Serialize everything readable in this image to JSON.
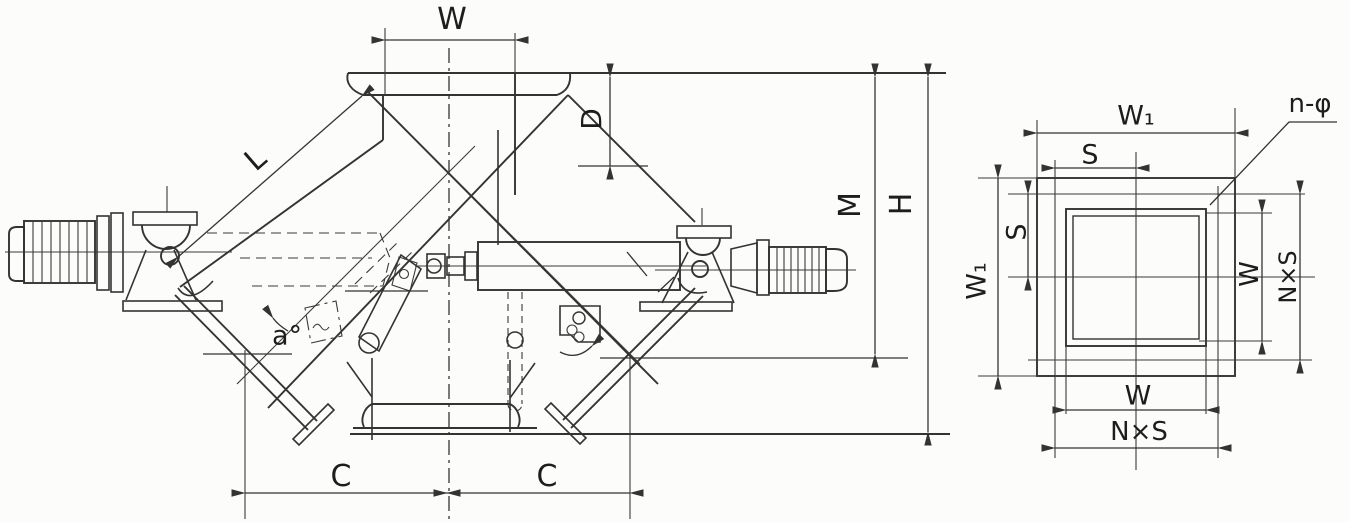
{
  "colors": {
    "background": "#fcfcfa",
    "line": "#333333",
    "text": "#1d1d1d"
  },
  "side_view": {
    "labels": {
      "inlet_width": "W",
      "flap_length": "L",
      "inlet_depth": "D",
      "base_height": "M",
      "overall_height": "H",
      "center_to_left": "C",
      "center_to_right": "C",
      "flap_open_angle": "a°"
    }
  },
  "flange_view": {
    "labels": {
      "outer_width_top": "W₁",
      "bolt_pitch_top": "S",
      "bolt_holes": "n-φ",
      "outer_width_left": "W₁",
      "bolt_pitch_left": "S",
      "opening_width_right": "W",
      "bolt_span_right": "N×S",
      "opening_width_bottom": "W",
      "bolt_span_bottom": "N×S"
    }
  }
}
